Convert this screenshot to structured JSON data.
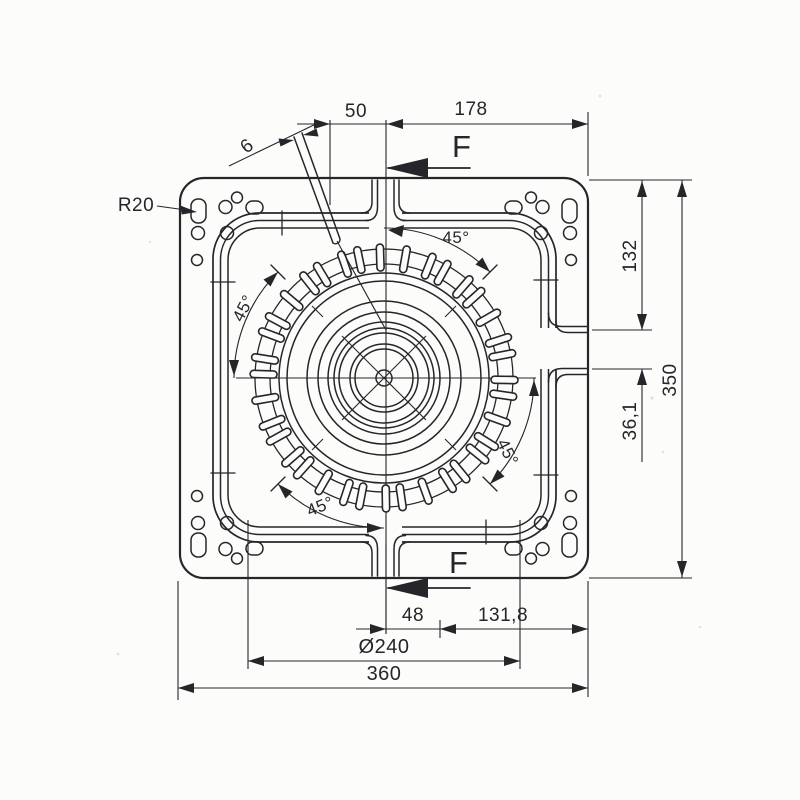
{
  "labels": {
    "corner_radius": "R20",
    "slot_width": "6",
    "top_width_left": "50",
    "top_width_right": "178",
    "section_top": "F",
    "section_bottom": "F",
    "right_height_upper": "132",
    "right_height_gap": "36,1",
    "right_height_total": "350",
    "bottom_offset": "48",
    "bottom_width_right": "131,8",
    "gear_diameter": "Ø240",
    "bottom_width_total": "360",
    "angles": {
      "top_right": "45°",
      "top_left": "45°",
      "bottom_left": "45°",
      "bottom_right": "45°"
    }
  },
  "colors": {
    "ink": "#26262a",
    "paper": "#fcfcfa"
  }
}
